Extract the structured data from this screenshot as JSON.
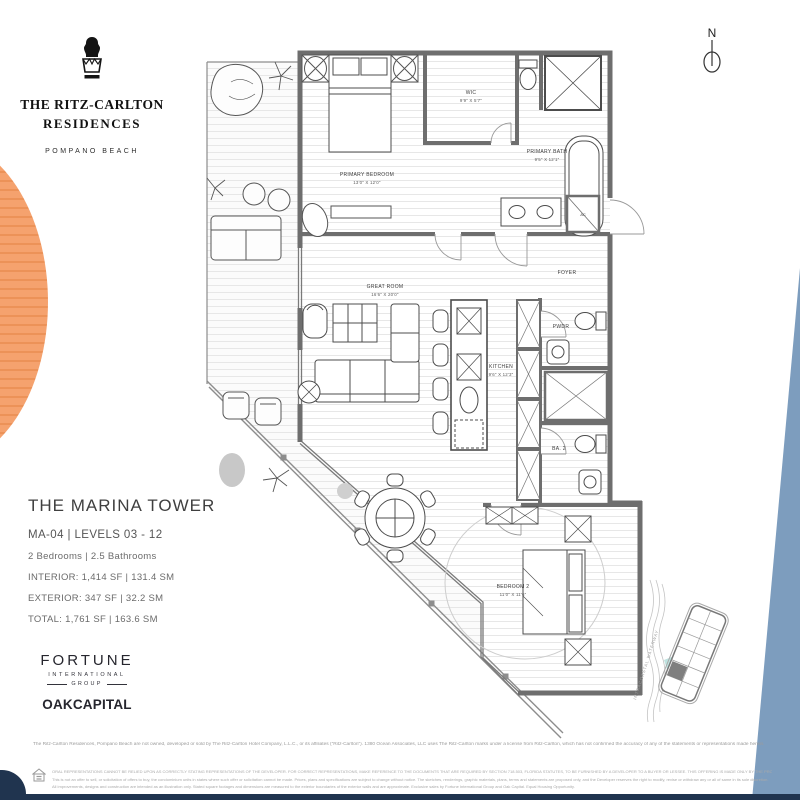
{
  "brand": {
    "line1": "THE RITZ-CARLTON",
    "line2": "RESIDENCES",
    "location": "POMPANO BEACH"
  },
  "compass": {
    "label": "N"
  },
  "unit": {
    "title": "THE MARINA TOWER",
    "unit_line": "MA-04 | LEVELS 03 - 12",
    "beds_baths": "2 Bedrooms | 2.5 Bathrooms",
    "interior": "INTERIOR: 1,414 SF | 131.4 SM",
    "exterior": "EXTERIOR: 347 SF | 32.2 SM",
    "total": "TOTAL: 1,761 SF | 163.6 SM"
  },
  "developers": {
    "fortune_line1": "FORTUNE",
    "fortune_line2": "INTERNATIONAL",
    "fortune_line3": "GROUP",
    "oak": "OAKCAPITAL"
  },
  "floorplan": {
    "rooms": {
      "primary_bedroom": {
        "name": "PRIMARY BEDROOM",
        "dims": "13'0\" X 12'0\""
      },
      "wic": {
        "name": "WIC",
        "dims": "9'9\" X 5'7\""
      },
      "primary_bath": {
        "name": "PRIMARY BATH",
        "dims": "9'5\" X 12'1\""
      },
      "great_room": {
        "name": "GREAT ROOM",
        "dims": "16'6\" X 20'0\""
      },
      "kitchen": {
        "name": "KITCHEN",
        "dims": "9'6\" X 12'3\""
      },
      "foyer": {
        "name": "FOYER"
      },
      "powder": {
        "name": "PWDR"
      },
      "bath2": {
        "name": "BA. 2"
      },
      "bedroom2": {
        "name": "BEDROOM 2",
        "dims": "11'0\" X 11'6\""
      },
      "ac": {
        "name": "AC"
      }
    }
  },
  "keyplan": {
    "waterway_label": "INTRACOASTAL WATERWAY"
  },
  "disclaimer": {
    "license_line": "The Ritz-Carlton Residences, Pompano Beach are not owned, developed or sold by The Ritz-Carlton Hotel Company, L.L.C., or its affiliates (“Ritz-Carlton”). 1380 Ocean Associates, LLC uses The Ritz-Carlton marks under a license from Ritz-Carlton, which has not confirmed the accuracy of any of the statements or representations made herein.",
    "fine_print": [
      "ORAL REPRESENTATIONS CANNOT BE RELIED UPON AS CORRECTLY STATING REPRESENTATIONS OF THE DEVELOPER. FOR CORRECT REPRESENTATIONS, MAKE REFERENCE TO THE DOCUMENTS THAT ARE REQUIRED BY SECTION 718.503, FLORIDA STATUTES, TO BE FURNISHED BY A DEVELOPER TO A BUYER OR LESSEE. THIS OFFERING IS MADE ONLY BY THE PROSPECTUS FOR THE CONDOMINIUM.",
      "This is not an offer to sell, or solicitation of offers to buy, the condominium units in states where such offer or solicitation cannot be made. Prices, plans and specifications are subject to change without notice. The sketches, renderings, graphic materials, plans, terms and statements are proposed only, and the Developer reserves the right to modify, revise or withdraw any or all of same in its sole discretion.",
      "All improvements, designs and construction are intended as an illustration only. Stated square footages and dimensions are measured to the exterior boundaries of the exterior walls and are approximate. Exclusive sales by Fortune International Group and Oak Capital. Equal Housing Opportunity."
    ]
  },
  "colors": {
    "accent_orange": "#F5A26E",
    "accent_blue": "#7D9DBE",
    "footer_navy": "#20344F",
    "wall_gray": "#6E6E6E",
    "keyplan_teal": "#A8DCD9"
  }
}
